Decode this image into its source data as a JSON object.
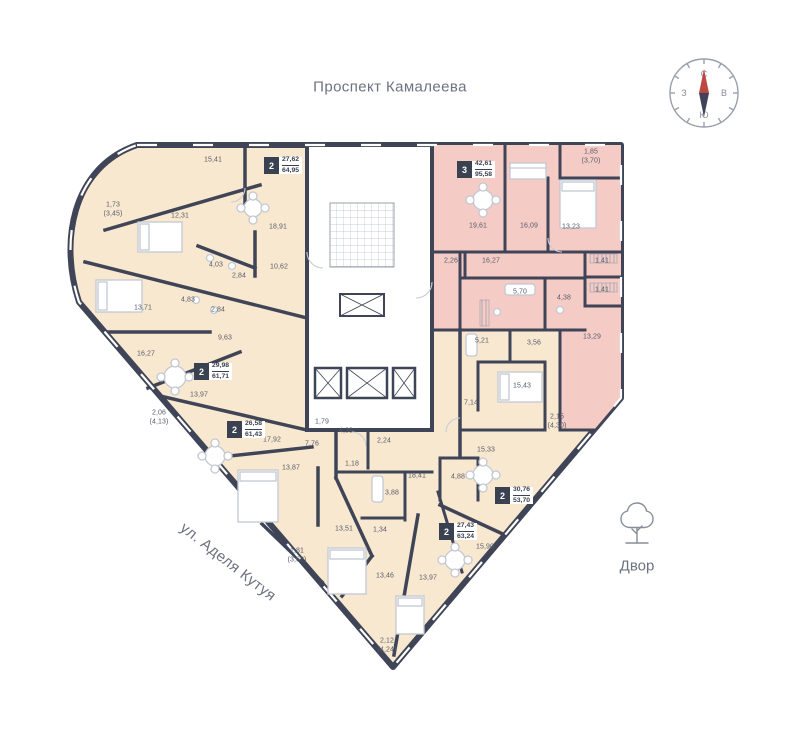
{
  "page": {
    "background": "#ffffff"
  },
  "labels": {
    "street_top": "Проспект Камалеева",
    "street_left": "ул. Аделя Кутуя",
    "courtyard": "Двор"
  },
  "compass": {
    "north": "С",
    "south": "Ю",
    "west": "З",
    "east": "В"
  },
  "colors": {
    "apartment_fill": "#f9e8d0",
    "selected_apartment_fill": "#f5cbc6",
    "wall": "#3f4557",
    "compass_needle_red": "#bf4742",
    "label_text": "#565c69",
    "street_text": "#6d7280"
  },
  "plan": {
    "apartments": [
      {
        "rooms": "2",
        "area_living": "27,62",
        "area_total": "64,95",
        "x": 264,
        "y": 157,
        "selected": false
      },
      {
        "rooms": "3",
        "area_living": "42,61",
        "area_total": "95,58",
        "x": 457,
        "y": 161,
        "selected": true
      },
      {
        "rooms": "2",
        "area_living": "29,98",
        "area_total": "61,71",
        "x": 194,
        "y": 363,
        "selected": false
      },
      {
        "rooms": "2",
        "area_living": "26,58",
        "area_total": "61,43",
        "x": 227,
        "y": 421,
        "selected": false
      },
      {
        "rooms": "2",
        "area_living": "27,43",
        "area_total": "63,24",
        "x": 439,
        "y": 523,
        "selected": false
      },
      {
        "rooms": "2",
        "area_living": "30,76",
        "area_total": "53,70",
        "x": 495,
        "y": 487,
        "selected": false
      }
    ],
    "room_labels": [
      {
        "text": "15,41",
        "x": 213,
        "y": 161
      },
      {
        "text": "1,73",
        "sub": "(3,45)",
        "x": 113,
        "y": 210
      },
      {
        "text": "12,31",
        "x": 180,
        "y": 217
      },
      {
        "text": "18,91",
        "x": 278,
        "y": 228
      },
      {
        "text": "4,03",
        "x": 216,
        "y": 266
      },
      {
        "text": "2,84",
        "x": 239,
        "y": 277
      },
      {
        "text": "10,62",
        "x": 279,
        "y": 268
      },
      {
        "text": "13,71",
        "x": 143,
        "y": 309
      },
      {
        "text": "4,83",
        "x": 188,
        "y": 301
      },
      {
        "text": "2,84",
        "x": 218,
        "y": 311
      },
      {
        "text": "9,63",
        "x": 225,
        "y": 339
      },
      {
        "text": "16,27",
        "x": 146,
        "y": 355
      },
      {
        "text": "13,97",
        "x": 199,
        "y": 396
      },
      {
        "text": "2,06",
        "sub": "(4,13)",
        "x": 159,
        "y": 418
      },
      {
        "text": "17,92",
        "x": 272,
        "y": 441
      },
      {
        "text": "13,87",
        "x": 291,
        "y": 469
      },
      {
        "text": "13,51",
        "x": 344,
        "y": 530
      },
      {
        "text": "1,81",
        "sub": "(3,62)",
        "x": 297,
        "y": 556
      },
      {
        "text": "1,79",
        "x": 322,
        "y": 423
      },
      {
        "text": "7,76",
        "x": 312,
        "y": 445
      },
      {
        "text": "4,39",
        "x": 346,
        "y": 432
      },
      {
        "text": "1,18",
        "x": 352,
        "y": 465
      },
      {
        "text": "2,24",
        "x": 384,
        "y": 442
      },
      {
        "text": "18,41",
        "x": 417,
        "y": 477
      },
      {
        "text": "3,88",
        "x": 392,
        "y": 494
      },
      {
        "text": "1,34",
        "x": 380,
        "y": 531
      },
      {
        "text": "13,46",
        "x": 385,
        "y": 577
      },
      {
        "text": "13,97",
        "x": 428,
        "y": 579
      },
      {
        "text": "2,12",
        "sub": "(4,24)",
        "x": 387,
        "y": 646
      },
      {
        "text": "15,90",
        "x": 485,
        "y": 548
      },
      {
        "text": "15,43",
        "x": 522,
        "y": 387
      },
      {
        "text": "7,14",
        "x": 471,
        "y": 404
      },
      {
        "text": "2,15",
        "sub": "(4,30)",
        "x": 557,
        "y": 422
      },
      {
        "text": "15,33",
        "x": 486,
        "y": 451
      },
      {
        "text": "4,88",
        "x": 458,
        "y": 478
      },
      {
        "text": "5,21",
        "x": 482,
        "y": 342
      },
      {
        "text": "3,56",
        "x": 534,
        "y": 344
      },
      {
        "text": "19,61",
        "x": 478,
        "y": 227
      },
      {
        "text": "16,09",
        "x": 529,
        "y": 227
      },
      {
        "text": "13,23",
        "x": 571,
        "y": 228
      },
      {
        "text": "1,85",
        "sub": "(3,70)",
        "x": 591,
        "y": 157
      },
      {
        "text": "2,26",
        "x": 451,
        "y": 262
      },
      {
        "text": "16,27",
        "x": 491,
        "y": 262
      },
      {
        "text": "5,70",
        "x": 520,
        "y": 293
      },
      {
        "text": "4,38",
        "x": 564,
        "y": 299
      },
      {
        "text": "1,41",
        "x": 602,
        "y": 262
      },
      {
        "text": "1,41",
        "x": 602,
        "y": 291
      },
      {
        "text": "13,29",
        "x": 592,
        "y": 338
      }
    ]
  }
}
